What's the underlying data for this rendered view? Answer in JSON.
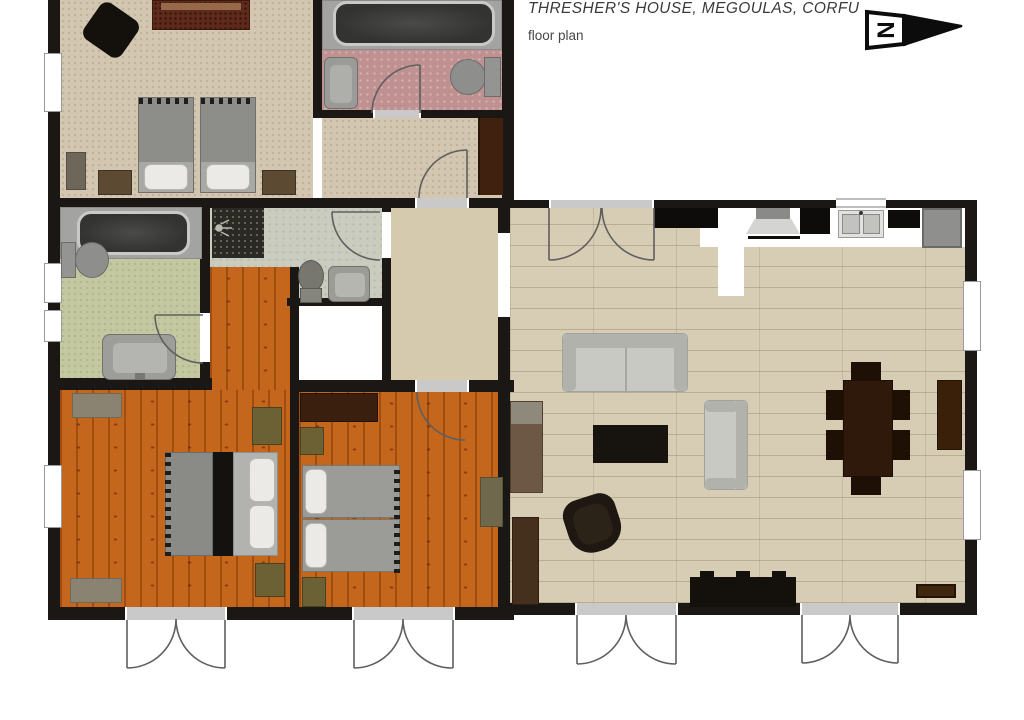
{
  "header": {
    "title": "THRESHER'S HOUSE, MEGOULAS, CORFU",
    "subtitle": "floor plan"
  },
  "north_arrow": {
    "label": "N"
  },
  "colors": {
    "wall": "#1a1714",
    "door_line": "#5f5f5f",
    "sill": "#c9c9c9",
    "floor_beige": "#d3c7b1",
    "floor_pink": "#c09191",
    "floor_green": "#c3c8a0",
    "floor_wc": "#caccbf",
    "floor_tile": "#2b2923",
    "floor_orange": "#c4661c",
    "floor_plank": "#d7cdb4",
    "floor_kitchen": "#ffffff",
    "floor_entrance": "#d5c9ae",
    "fixture_grey": "#9a9a96",
    "tub_dark": "#3a3a38",
    "furn_olive": "#6b6134",
    "furn_brown": "#5c4a33",
    "furn_darkbrown": "#3b1f0e",
    "furn_black": "#14110d",
    "sofa_grey": "#c9c9c4",
    "table_brown": "#2e190b"
  }
}
